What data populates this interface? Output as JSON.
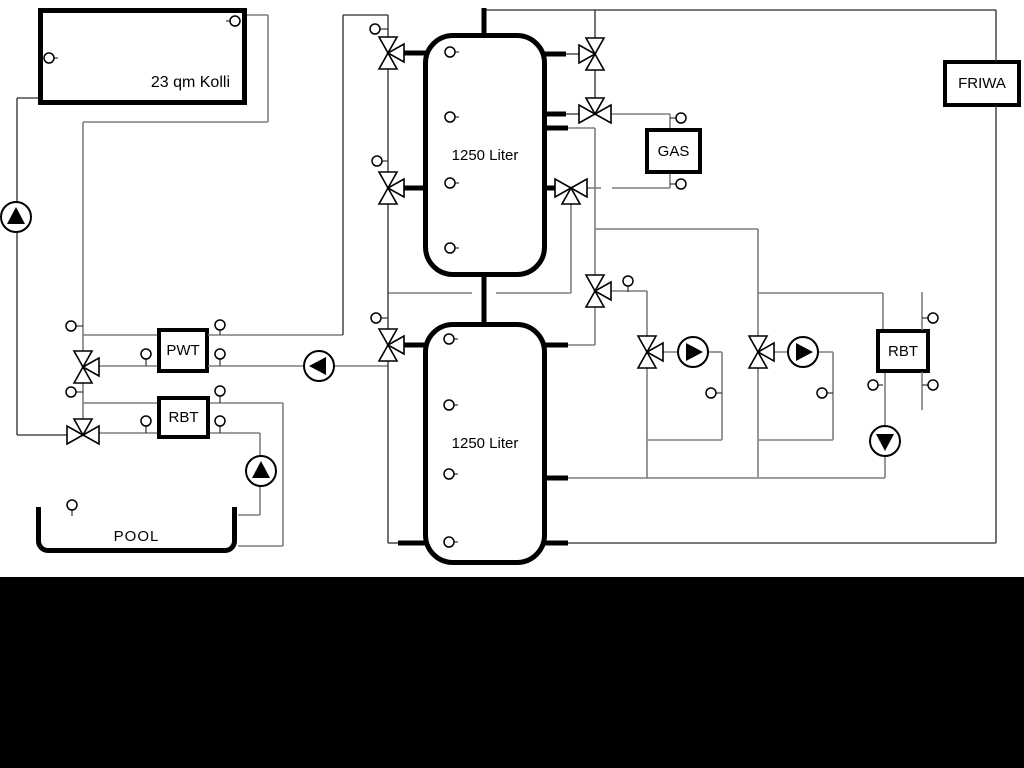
{
  "components": {
    "collector": {
      "label": "23 qm Kolli"
    },
    "tank1": {
      "label": "1250 Liter"
    },
    "tank2": {
      "label": "1250 Liter"
    },
    "gas_boiler": {
      "label": "GAS"
    },
    "friwa": {
      "label": "FRIWA"
    },
    "pwt": {
      "label": "PWT"
    },
    "rbt_pool": {
      "label": "RBT"
    },
    "rbt_right": {
      "label": "RBT"
    },
    "pool": {
      "label": "POOL"
    }
  },
  "icons": {
    "valve": "three-way-valve-icon",
    "pump": "pump-icon",
    "sensor": "temperature-sensor-icon"
  },
  "colors": {
    "pipe_gray": "#7e7e7e",
    "pipe_dark": "#2a2a2a",
    "component_border": "#000000",
    "background": "#ffffff",
    "letterbox": "#000000"
  }
}
